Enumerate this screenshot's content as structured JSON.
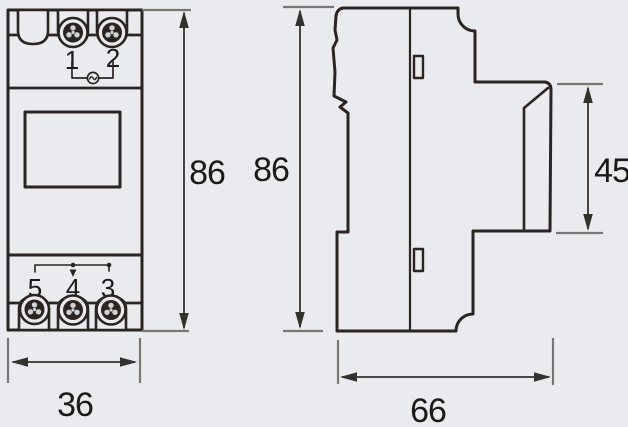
{
  "drawing": {
    "views": {
      "front": "front-view",
      "side": "side-view"
    }
  },
  "front_view": {
    "top_terminal_labels": [
      "1",
      "2"
    ],
    "bottom_terminal_labels": [
      "5",
      "4",
      "3"
    ]
  },
  "dimensions": {
    "front_height_label": "86",
    "side_height_label": "86",
    "panel_height_label": "45",
    "width_label": "36",
    "depth_label": "66"
  },
  "icons": {
    "screw": "screw-head-circle",
    "ac_supply": "circle-with-tilde",
    "changeover_contact": "switch-contact-line"
  },
  "colors": {
    "background": "#e9ebee",
    "outline": "#2b2421",
    "dimension_line": "#35312d",
    "extension_line": "#7c7670",
    "text": "#1c1a18",
    "screw_dot": "#cfd2d4"
  }
}
